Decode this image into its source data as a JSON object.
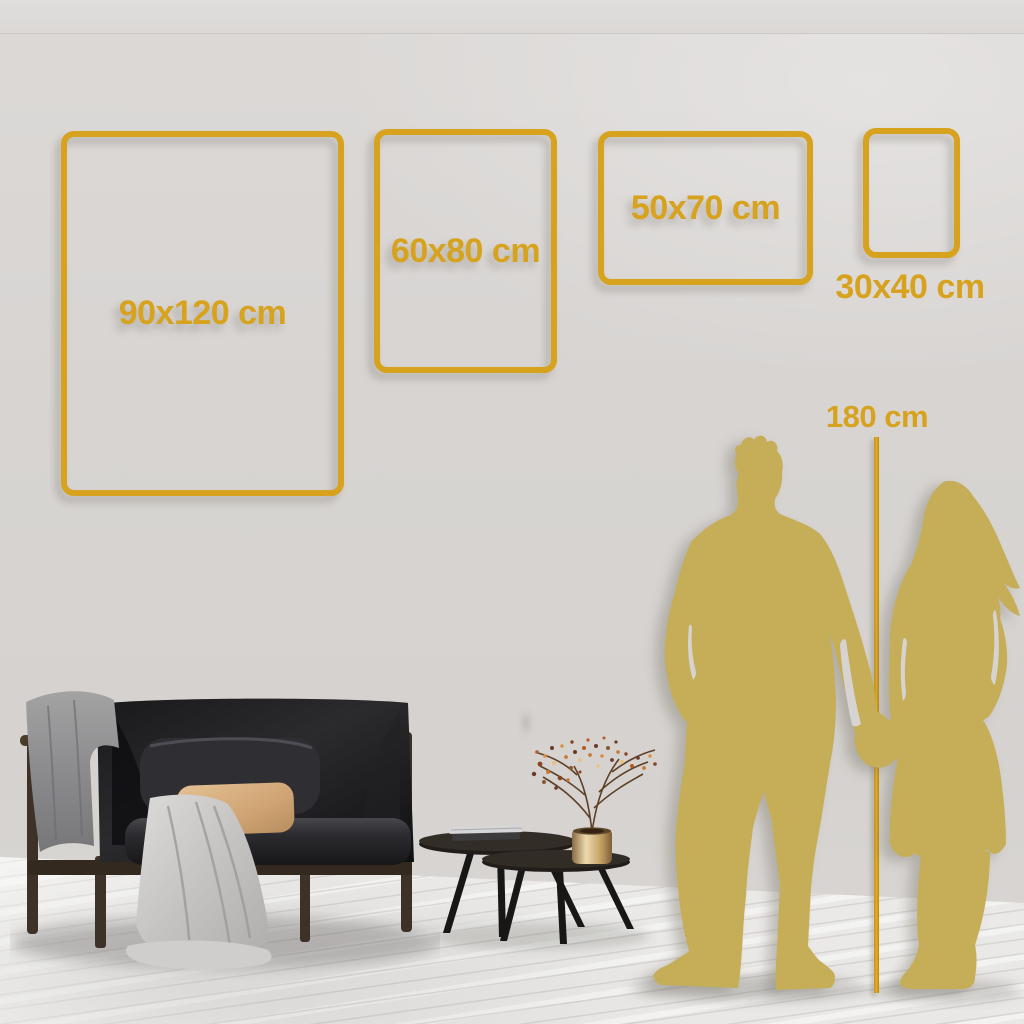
{
  "size_guide": {
    "frames": [
      {
        "id": "90x120",
        "label": "90x120 cm",
        "width_cm": 90,
        "height_cm": 120,
        "orientation": "portrait"
      },
      {
        "id": "60x80",
        "label": "60x80 cm",
        "width_cm": 60,
        "height_cm": 80,
        "orientation": "portrait"
      },
      {
        "id": "50x70",
        "label": "50x70 cm",
        "width_cm": 50,
        "height_cm": 70,
        "orientation": "landscape"
      },
      {
        "id": "30x40",
        "label": "30x40 cm",
        "width_cm": 30,
        "height_cm": 40,
        "orientation": "portrait"
      }
    ],
    "height_reference": {
      "label": "180 cm",
      "height_cm": 180
    }
  },
  "colors": {
    "accent_gold": "#d7a21d",
    "silhouette_gold": "#c6ae58",
    "wall": "#d7d4d2",
    "floor": "#f1f0ee"
  },
  "scene": {
    "icons": [
      "couple-silhouette-icon",
      "sofa-illustration",
      "nesting-coffee-tables",
      "brass-vase-dried-branch",
      "height-ruler-line"
    ]
  }
}
